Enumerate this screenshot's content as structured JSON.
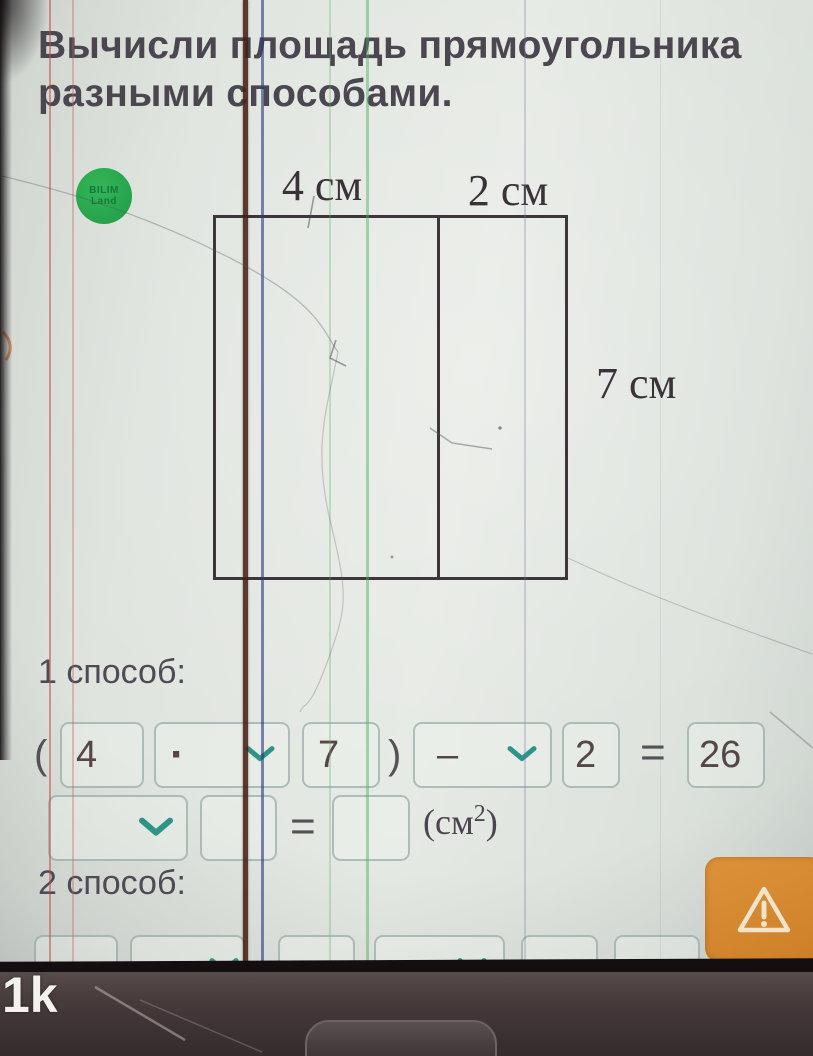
{
  "colors": {
    "accent_teal": "#2f9488",
    "warning_orange": "#d8892f",
    "logo_green": "#27a74a"
  },
  "screen": {
    "title_line1": "Вычисли площадь прямоугольника",
    "title_line2": "разными способами.",
    "logo_line1": "BILIM",
    "logo_line2": "Land",
    "diagram": {
      "width_left": "4 см",
      "width_right": "2 см",
      "height": "7 см"
    },
    "method1": {
      "heading": "1 способ:",
      "open_paren": "(",
      "factor1": "4",
      "operator1": "·",
      "factor2": "7",
      "close_paren": ")",
      "operator2": "–",
      "subtrahend": "2",
      "equals": "=",
      "result": "26",
      "row2_dropdown_value": "",
      "row2_field1_value": "",
      "row2_equals": "=",
      "row2_field2_value": "",
      "unit_prefix": "(см",
      "unit_exponent": "2",
      "unit_suffix": ")"
    },
    "method2": {
      "heading": "2 способ:"
    }
  },
  "device": {
    "watermark": "1k"
  }
}
